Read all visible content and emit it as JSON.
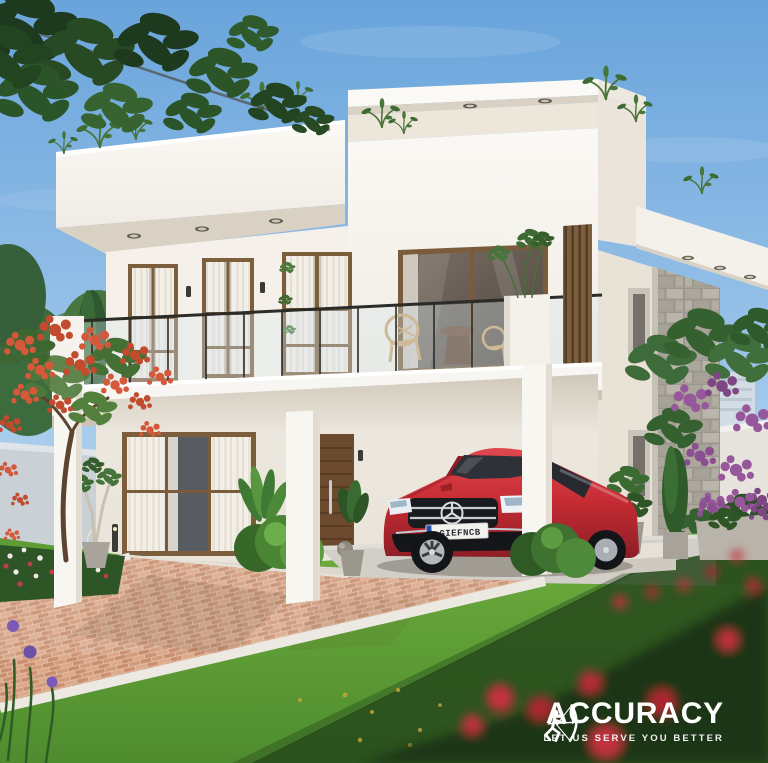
{
  "watermark": {
    "brand": "ACCURACY",
    "tagline": "LET US SERVE YOU BETTER",
    "color": "#FFFFFF",
    "icon": "archer-bow-icon"
  },
  "car": {
    "license_plate": "GIEFNCB",
    "body_color": "#C42B33",
    "emblem": "mercedes-star"
  },
  "palette": {
    "sky_top": "#69A4DB",
    "sky_horizon": "#C9E1F3",
    "house_white": "#F8F5F0",
    "soffit_shadow": "#D8D1C4",
    "wood_frame": "#7C5E3C",
    "door_wood": "#6B4A2E",
    "stone_cladding": "#B2ADA4",
    "lawn_sunlit": "#6FAE3E",
    "lawn_shadow": "#26491B",
    "brick_paver": "#E2BFA6",
    "curb": "#ECE9E3",
    "flame_tree_bloom": "#D4583A",
    "bougainvillea": "#96589A",
    "rose": "#C2303C",
    "iris": "#7B5BB5",
    "railing_metal": "#2B2B28",
    "glass_tint": "#D7E4EC"
  }
}
